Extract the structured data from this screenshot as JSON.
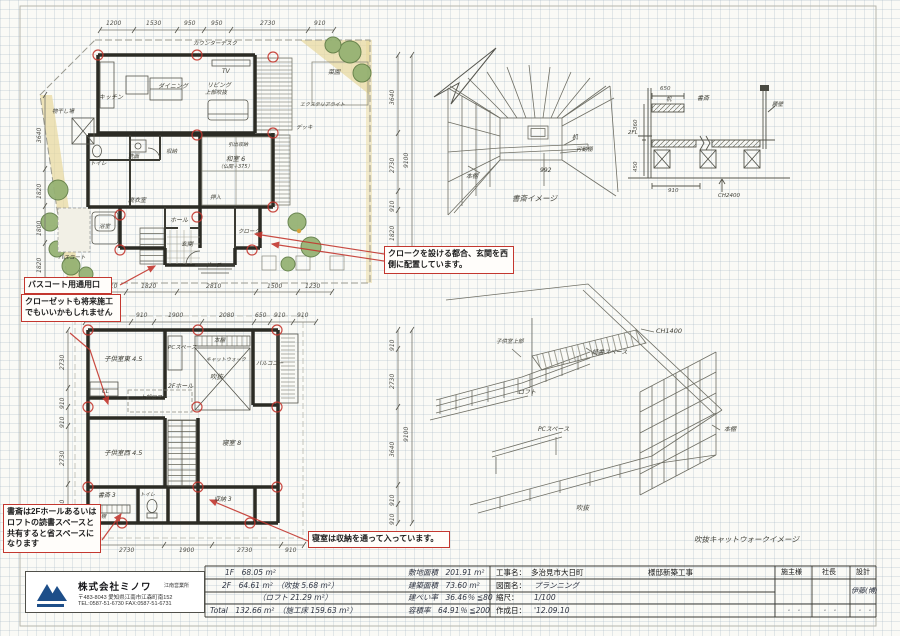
{
  "colors": {
    "annotation_red": "#c3372f",
    "logo_blue": "#1d4e89"
  },
  "ann": {
    "bath": "バスコート用通用口",
    "closet": "クローゼットも将来施工でもいいかもしれません",
    "cloak": "クロークを設ける都合、玄関を西側に配置しています。",
    "study": "書斎は2Fホールあるいはロフトの読書スペースと共有すると省スペースになります",
    "bedroom": "寝室は収納を通って入っています。"
  },
  "d1": {
    "top": [
      "1200",
      "1530",
      "950",
      "950",
      "2730",
      "910"
    ],
    "left": [
      "3640",
      "1820",
      "1800",
      "1820"
    ],
    "right": [
      "3640",
      "2730",
      "910",
      "1820"
    ],
    "rtot": "9100",
    "bottom": [
      "910",
      "1820",
      "2810",
      "1500",
      "1230"
    ]
  },
  "d2": {
    "top": [
      "1820",
      "910",
      "1900",
      "2080",
      "650",
      "910",
      "910"
    ],
    "left": [
      "2730",
      "910",
      "910",
      "2730",
      "1820"
    ],
    "right": [
      "910",
      "2730",
      "3640",
      "910",
      "910"
    ],
    "rtot": "9100",
    "bottom": [
      "2730",
      "1900",
      "2730",
      "910"
    ]
  },
  "r1": {
    "counter": "カウンターデスク",
    "tv": "TV",
    "living": "リビング",
    "living2": "上部吹抜",
    "dining": "ダイニング",
    "kitchen": "キッチン",
    "monohoshi": "物干し場",
    "toilet": "トイレ",
    "senmen": "洗面",
    "shuno": "収納",
    "datsui": "脱衣室",
    "bath": "浴室",
    "bathcourt": "バスコート",
    "washitsu": "和室 6",
    "washitsu2": "（仏間＋375）",
    "hikidashi": "引出収納",
    "oshiire": "押入",
    "cloak": "クローク",
    "hall": "ホール",
    "genkan": "玄関",
    "porch": "ポーチ",
    "deck": "デッキ",
    "saien": "菜園",
    "extlight": "エクステリアライト"
  },
  "r2": {
    "kids_e": "子供室東 4.5",
    "pc": "PCスペース",
    "shelf_top": "本棚",
    "catwalk": "キャットウォーク",
    "void": "吹抜",
    "balcony": "バルコニー",
    "hall": "2Fホール",
    "loft": "上部ロフト",
    "cl": "CL",
    "kids_w": "子供室西 4.5",
    "bedroom": "寝室 8",
    "study": "書斎 3",
    "shelf2": "本棚",
    "storage": "収納 3",
    "toilet": "トイレ"
  },
  "sk1": {
    "caption": "書斎イメージ",
    "shelf": "本棚",
    "desk": "机",
    "movable": "可動棚",
    "w992": "992"
  },
  "sec": {
    "d650": "650",
    "desk": "机",
    "study": "書斎",
    "wall": "腰壁",
    "fl2": "2FL",
    "d360": "360",
    "d450": "450",
    "d910": "910",
    "ch": "CH2400"
  },
  "sk2": {
    "ch": "CH1400",
    "kids": "子供室上部",
    "reading": "読書スペース",
    "loft": "ロフト",
    "pc": "PCスペース",
    "shelf": "本棚",
    "void": "吹抜",
    "caption": "吹抜キャットウォークイメージ"
  },
  "tb": {
    "company": {
      "name": "株式会社ミノワ",
      "branch": "江南営業所",
      "zip": "〒483-8043 愛知県江南市江森町南152",
      "tel": "TEL:0587-51-6730 FAX:0587-51-6731"
    },
    "areas": {
      "l0": "1F　68.05 m²",
      "l1": "2F　64.61 m²　（吹抜 5.68 m²）",
      "l2": "（ロフト 21.29 m²）",
      "l3": "Total　132.66 m²　（施工床 159.63 m²）",
      "r0": "敷地面積　201.91 m²",
      "r1": "建築面積　73.60 m²",
      "r2": "建ぺい率　36.46％ ≦80",
      "r3": "容積率　64.91％ ≦200"
    },
    "project": {
      "f1l": "工事名：",
      "f1v": "多治見市大日町",
      "f1s": "様邸新築工事",
      "f2l": "図面名：",
      "f2v": "プランニング",
      "f3l": "縮尺：",
      "f3v": "1/100",
      "f4l": "作成日：",
      "f4v": "'12.09.10",
      "c1": "施主様",
      "c2": "社長",
      "c3": "設計",
      "designer": "伊藤(博)",
      "dots": "・　・"
    }
  }
}
